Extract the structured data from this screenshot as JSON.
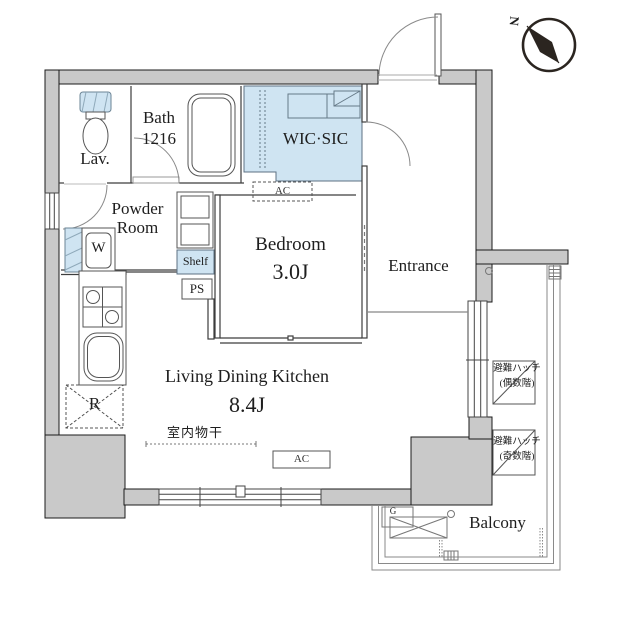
{
  "colors": {
    "wall": "#c9c9c9",
    "accent": "#cfe4f2",
    "outline": "#1b1b1b"
  },
  "compass": {
    "north": "N"
  },
  "rooms": {
    "lav": {
      "name": "Lav."
    },
    "bath": {
      "name": "Bath",
      "size": "1216"
    },
    "powder": {
      "name_line1": "Powder",
      "name_line2": "Room"
    },
    "wic": {
      "name": "WIC·SIC"
    },
    "bedroom": {
      "name": "Bedroom",
      "size": "3.0J"
    },
    "entrance": {
      "name": "Entrance"
    },
    "ldk": {
      "name": "Living Dining Kitchen",
      "size": "8.4J"
    },
    "balcony": {
      "name": "Balcony"
    }
  },
  "labels": {
    "ac": "AC",
    "ps": "PS",
    "shelf": "Shelf",
    "washer": "W",
    "refrigerator": "R",
    "gas_meter": "G",
    "indoor_drying": "室内物干",
    "hatch_line1": "避難ハッチ",
    "hatch_even": "(偶数階)",
    "hatch_odd": "(奇数階)"
  }
}
